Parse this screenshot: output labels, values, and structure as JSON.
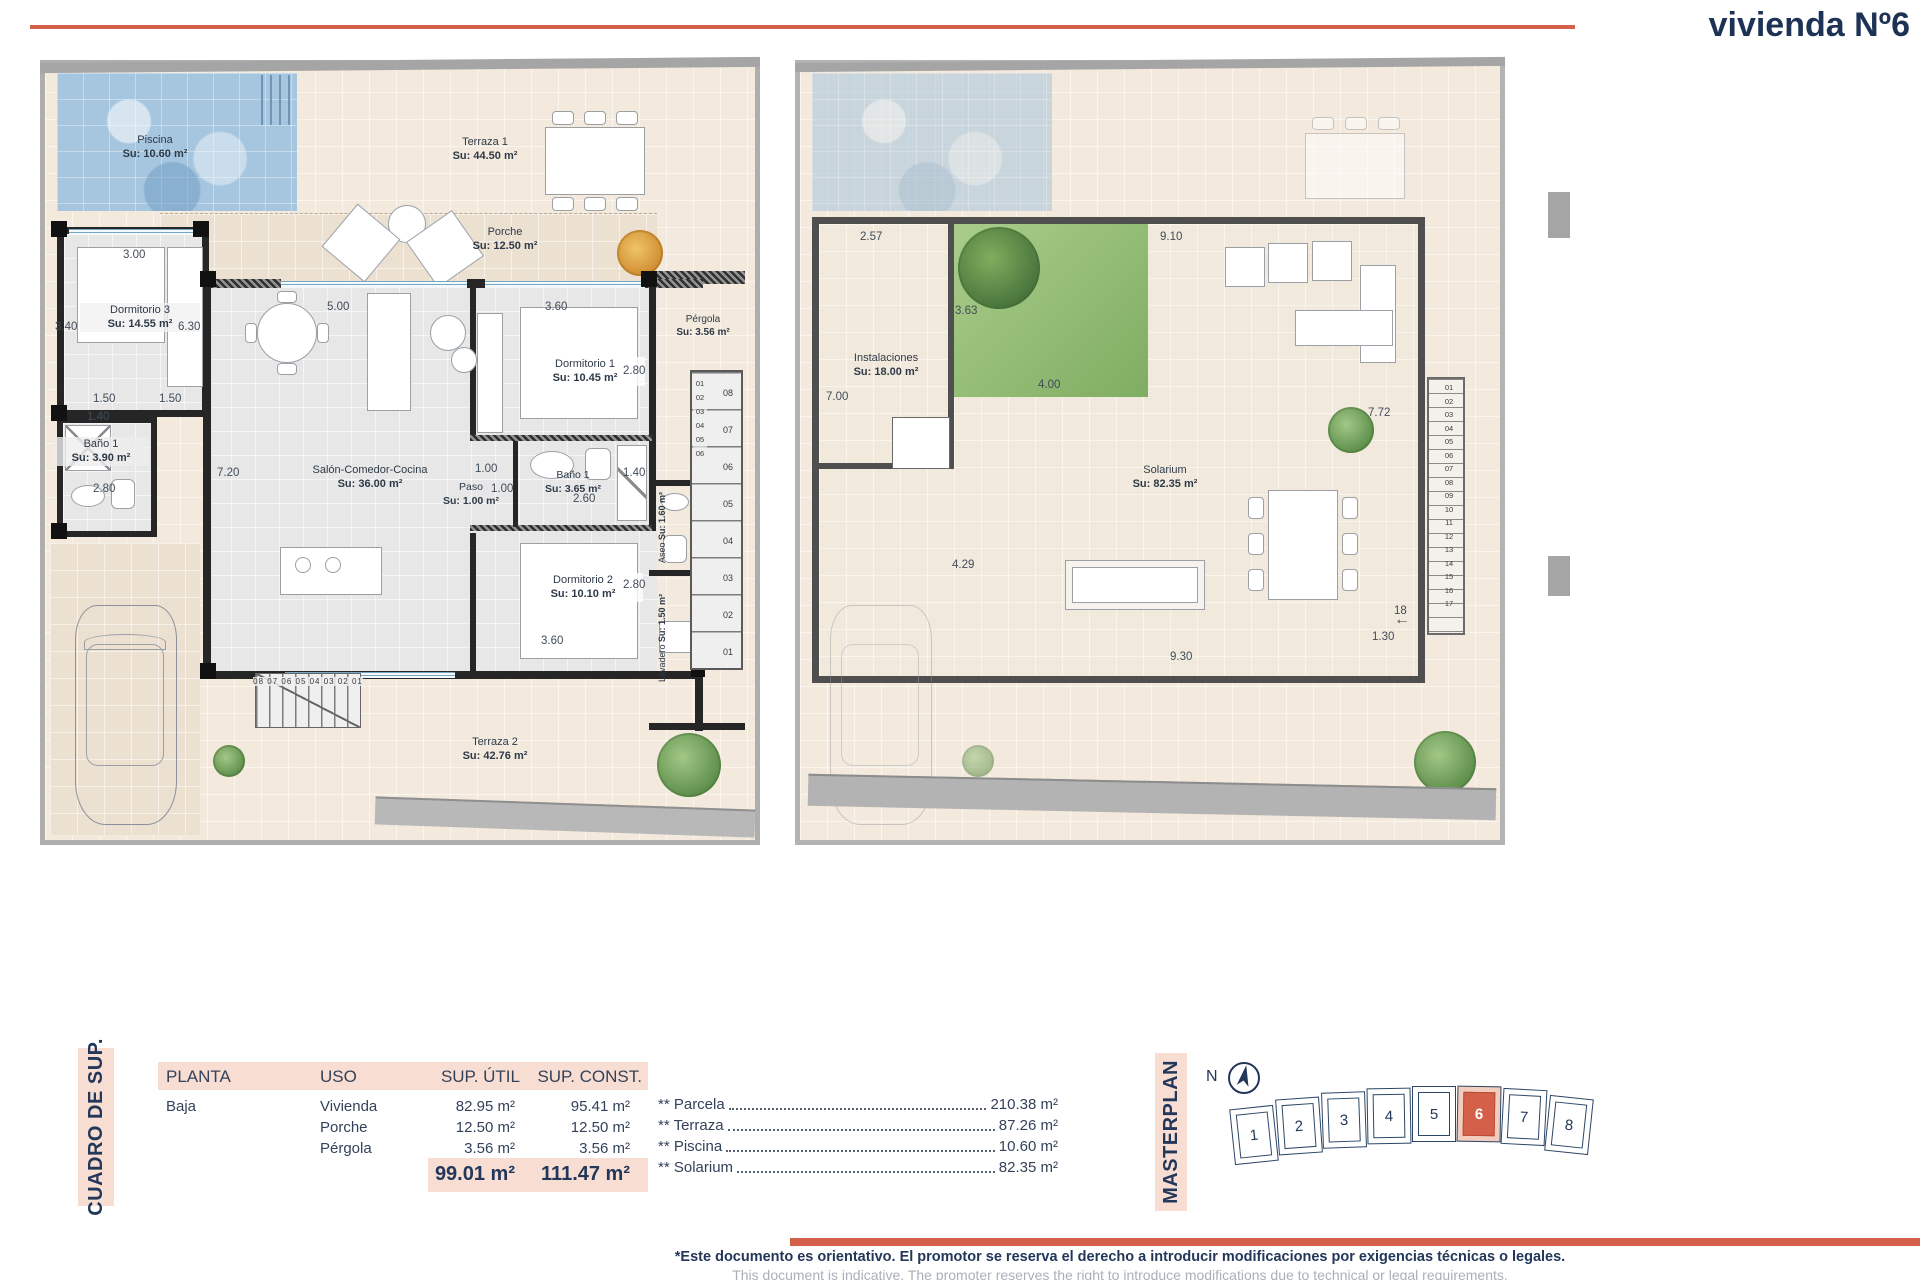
{
  "title": "vivienda Nº6",
  "plan_left": {
    "piscina": {
      "name": "Piscina",
      "area": "Su: 10.60 m²"
    },
    "terraza1": {
      "name": "Terraza 1",
      "area": "Su: 44.50 m²"
    },
    "porche": {
      "name": "Porche",
      "area": "Su: 12.50 m²"
    },
    "dormitorio3": {
      "name": "Dormitorio 3",
      "area": "Su: 14.55 m²"
    },
    "bano1_izq": {
      "name": "Baño 1",
      "area": "Su: 3.90 m²"
    },
    "salon": {
      "name": "Salón-Comedor-Cocina",
      "area": "Su: 36.00 m²"
    },
    "dormitorio1": {
      "name": "Dormitorio 1",
      "area": "Su: 10.45 m²"
    },
    "paso": {
      "name": "Paso",
      "area": "Su: 1.00 m²"
    },
    "bano1_der": {
      "name": "Baño 1",
      "area": "Su: 3.65 m²"
    },
    "dormitorio2": {
      "name": "Dormitorio 2",
      "area": "Su: 10.10 m²"
    },
    "aseo": {
      "name": "Aseo",
      "area": "Su: 1.60 m²"
    },
    "lavadero": {
      "name": "Lavadero",
      "area": "Su: 1.50 m²"
    },
    "pergola": {
      "name": "Pérgola",
      "area": "Su: 3.56 m²"
    },
    "terraza2": {
      "name": "Terraza 2",
      "area": "Su: 42.76 m²"
    },
    "dims": {
      "d300": "3.00",
      "d340": "3.40",
      "d630": "6.30",
      "d150a": "1.50",
      "d150b": "1.50",
      "d140a": "1.40",
      "d280a": "2.80",
      "d500": "5.00",
      "d720": "7.20",
      "d360a": "3.60",
      "d280b": "2.80",
      "d100a": "1.00",
      "d100b": "1.00",
      "d260": "2.60",
      "d140b": "1.40",
      "d280c": "2.80",
      "d360b": "3.60"
    },
    "stairs_col_small": "01\n02\n03\n04\n05\n06",
    "stairs_col_big": "08\n07\n06\n05\n04\n03\n02\n01",
    "stairs_row": "08 07 06 05 04 03 02 01"
  },
  "plan_right": {
    "instalaciones": {
      "name": "Instalaciones",
      "area": "Su: 18.00 m²"
    },
    "solarium": {
      "name": "Solarium",
      "area": "Su: 82.35 m²"
    },
    "dims": {
      "d257": "2.57",
      "d910": "9.10",
      "d363": "3.63",
      "d400": "4.00",
      "d700": "7.00",
      "d772": "7.72",
      "d429": "4.29",
      "d930": "9.30",
      "d130": "1.30",
      "d18": "18"
    },
    "stairs_col": "01\n02\n03\n04\n05\n06\n07\n08\n09\n10\n11\n12\n13\n14\n15\n16\n17"
  },
  "table": {
    "title": "CUADRO DE SUP.",
    "headers": [
      "PLANTA",
      "USO",
      "SUP. ÚTIL",
      "SUP. CONST."
    ],
    "planta": "Baja",
    "rows": [
      {
        "uso": "Vivienda",
        "util": "82.95 m²",
        "const": "95.41 m²"
      },
      {
        "uso": "Porche",
        "util": "12.50 m²",
        "const": "12.50 m²"
      },
      {
        "uso": "Pérgola",
        "util": "3.56 m²",
        "const": "3.56 m²"
      }
    ],
    "total_util": "99.01 m²",
    "total_const": "111.47 m²"
  },
  "summary": [
    {
      "label": "** Parcela",
      "value": "210.38 m²"
    },
    {
      "label": "** Terraza",
      "value": "87.26 m²"
    },
    {
      "label": "** Piscina",
      "value": "10.60 m²"
    },
    {
      "label": "** Solarium",
      "value": "82.35 m²"
    }
  ],
  "masterplan": {
    "title": "MASTERPLAN",
    "north": "N",
    "units": [
      "1",
      "2",
      "3",
      "4",
      "5",
      "6",
      "7",
      "8"
    ],
    "highlighted": "6",
    "highlight_color": "#d4604a"
  },
  "footer": {
    "line1": "*Este documento es orientativo. El promotor se reserva el derecho a introducir modificaciones por exigencias técnicas o legales.",
    "line2": "This document is indicative. The promoter reserves the right to introduce modifications due to technical or legal requirements."
  }
}
